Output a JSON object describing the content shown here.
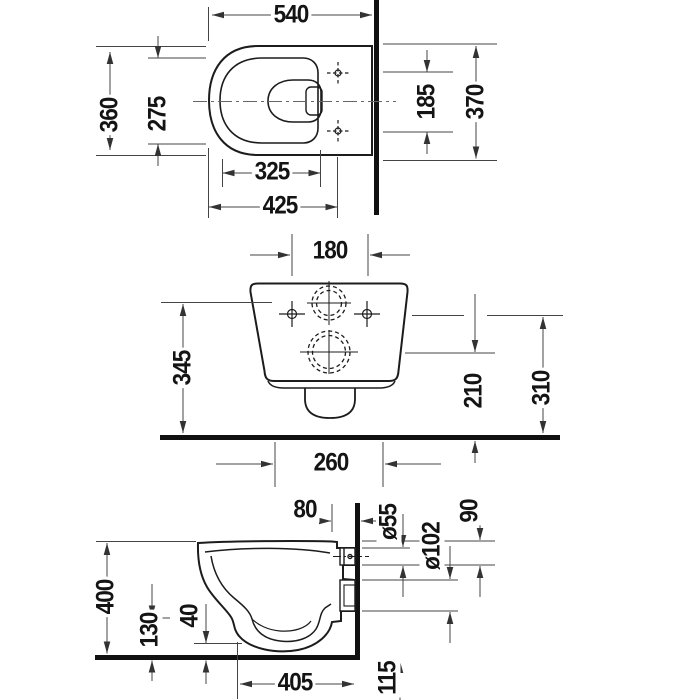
{
  "drawing": {
    "kind": "technical-dimension-drawing",
    "views": {
      "plan": {
        "dims": {
          "overall_depth": "540",
          "overall_width": "360",
          "rim_width": "275",
          "hole_spacing": "185",
          "seat_width": "370",
          "rim_depth": "325",
          "front_to_holes": "425"
        }
      },
      "front": {
        "dims": {
          "hole_spacing": "180",
          "inlet_height": "345",
          "outlet_height": "210",
          "hole_height": "310",
          "base_width": "260"
        }
      },
      "side": {
        "dims": {
          "holes_to_wall": "80",
          "inlet_diameter": "ø55",
          "top_to_inlet": "90",
          "outlet_diameter": "ø102",
          "overall_height": "400",
          "front_edge_height": "130",
          "bottom_clearance": "40",
          "wall_to_front_lower": "405",
          "below_floor": "115"
        }
      }
    }
  }
}
